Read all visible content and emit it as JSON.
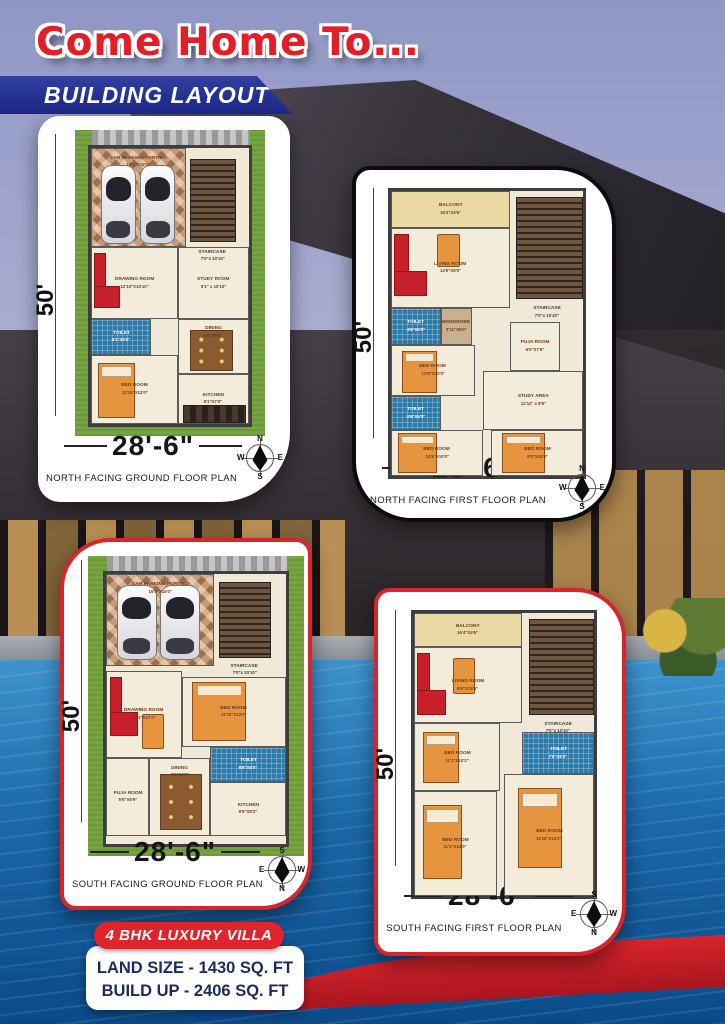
{
  "header": {
    "title": "Come Home To...",
    "banner": "BUILDING LAYOUT"
  },
  "footer": {
    "badge": "4 BHK LUXURY VILLA",
    "land_size": "LAND SIZE - 1430 SQ. FT",
    "build_up": "BUILD UP - 2406 SQ. FT"
  },
  "plans": [
    {
      "id": "north-ground",
      "title": "NORTH FACING GROUND FLOOR PLAN",
      "width_label": "28'-6\"",
      "height_label": "50'",
      "lawn": true,
      "compass": {
        "up": "N",
        "right": "E",
        "down": "S",
        "left": "W"
      },
      "rooms": [
        {
          "label": "CAR PARKING PORTICO",
          "dims": "16'4\"X15'0\"",
          "type": "carpark",
          "labelPos": "top",
          "x": 0,
          "y": 0,
          "w": 60,
          "h": 36
        },
        {
          "label": "",
          "dims": "",
          "type": "stairs",
          "x": 63,
          "y": 4,
          "w": 29,
          "h": 30
        },
        {
          "label": "Staircase",
          "dims": "7'0\"x 10'10\"",
          "type": "plain",
          "x": 58,
          "y": 34,
          "w": 38,
          "h": 10
        },
        {
          "label": "DRAWING ROOM",
          "dims": "12'10\"X10'10\"",
          "type": "room",
          "x": 0,
          "y": 36,
          "w": 55,
          "h": 26
        },
        {
          "label": "STUDY ROOM",
          "dims": "9'1\" x 10'10\"",
          "type": "room",
          "x": 55,
          "y": 36,
          "w": 45,
          "h": 26
        },
        {
          "label": "TOILET",
          "dims": "9'1\"X5'0\"",
          "type": "toilet",
          "x": 0,
          "y": 62,
          "w": 38,
          "h": 13
        },
        {
          "label": "DINING",
          "dims": "9'6\"X8'9\"",
          "type": "room",
          "labelPos": "top",
          "x": 55,
          "y": 62,
          "w": 45,
          "h": 20
        },
        {
          "label": "BED ROOM",
          "dims": "12'10\"X12'0\"",
          "type": "room",
          "x": 0,
          "y": 75,
          "w": 55,
          "h": 25
        },
        {
          "label": "KITCHEN",
          "dims": "9'1\"X7'0\"",
          "type": "room",
          "x": 55,
          "y": 82,
          "w": 45,
          "h": 18
        }
      ],
      "features": [
        {
          "type": "car",
          "x": 6,
          "y": 6,
          "w": 21,
          "h": 28
        },
        {
          "type": "car",
          "x": 31,
          "y": 6,
          "w": 21,
          "h": 28
        },
        {
          "type": "sofa",
          "x": 2,
          "y": 38,
          "w": 16,
          "h": 20
        },
        {
          "type": "bed",
          "x": 4,
          "y": 78,
          "w": 24,
          "h": 20
        },
        {
          "type": "table",
          "x": 63,
          "y": 66,
          "w": 26,
          "h": 14
        },
        {
          "type": "counter",
          "x": 58,
          "y": 93,
          "w": 39,
          "h": 6
        }
      ]
    },
    {
      "id": "north-first",
      "title": "NORTH FACING FIRST FLOOR PLAN",
      "width_label": "28'-6\"",
      "height_label": "50'",
      "lawn": false,
      "compass": {
        "up": "N",
        "right": "E",
        "down": "S",
        "left": "W"
      },
      "rooms": [
        {
          "label": "BALCONY",
          "dims": "16'4\"X4'6\"",
          "type": "balcony",
          "x": 0,
          "y": 0,
          "w": 62,
          "h": 13
        },
        {
          "label": "LIVING ROOM",
          "dims": "13'6\"X9'0\"",
          "type": "room",
          "x": 0,
          "y": 13,
          "w": 62,
          "h": 28
        },
        {
          "label": "",
          "dims": "",
          "type": "stairs",
          "x": 65,
          "y": 2,
          "w": 35,
          "h": 36
        },
        {
          "label": "Staircase",
          "dims": "7'0\"x 10'10\"",
          "type": "plain",
          "x": 62,
          "y": 38,
          "w": 38,
          "h": 9
        },
        {
          "label": "TOILET",
          "dims": "4'6\"X5'0\"",
          "type": "toilet",
          "x": 0,
          "y": 41,
          "w": 26,
          "h": 13
        },
        {
          "label": "WARDROBE",
          "dims": "3'11\"X5'0\"",
          "type": "wardrobe",
          "x": 26,
          "y": 41,
          "w": 16,
          "h": 13
        },
        {
          "label": "PUJA ROOM",
          "dims": "6'0\"X7'6\"",
          "type": "room",
          "x": 62,
          "y": 46,
          "w": 26,
          "h": 17
        },
        {
          "label": "BED ROOM",
          "dims": "12'6\"X10'0\"",
          "type": "room",
          "x": 0,
          "y": 54,
          "w": 44,
          "h": 18
        },
        {
          "label": "TOILET",
          "dims": "9'6\"X5'0\"",
          "type": "toilet",
          "x": 0,
          "y": 72,
          "w": 26,
          "h": 12
        },
        {
          "label": "STUDY AREA",
          "dims": "12'11\" x 8'9\"",
          "type": "room",
          "x": 48,
          "y": 63,
          "w": 52,
          "h": 21
        },
        {
          "label": "BED ROOM",
          "dims": "12'5\"X10'0\"",
          "type": "room",
          "x": 0,
          "y": 84,
          "w": 48,
          "h": 16
        },
        {
          "label": "BED ROOM",
          "dims": "9'6\"X12'0\"",
          "type": "room",
          "x": 52,
          "y": 84,
          "w": 48,
          "h": 16
        }
      ],
      "features": [
        {
          "type": "sofa",
          "x": 2,
          "y": 15,
          "w": 17,
          "h": 22
        },
        {
          "type": "chair",
          "x": 24,
          "y": 15,
          "w": 11,
          "h": 11
        },
        {
          "type": "bed",
          "x": 6,
          "y": 56,
          "w": 18,
          "h": 15
        },
        {
          "type": "bed",
          "x": 4,
          "y": 85,
          "w": 20,
          "h": 14
        },
        {
          "type": "bed",
          "x": 58,
          "y": 85,
          "w": 22,
          "h": 14
        }
      ]
    },
    {
      "id": "south-ground",
      "title": "SOUTH FACING GROUND FLOOR PLAN",
      "width_label": "28'-6\"",
      "height_label": "50'",
      "lawn": true,
      "compass": {
        "up": "S",
        "right": "W",
        "down": "N",
        "left": "E"
      },
      "rooms": [
        {
          "label": "CAR PARKING PORTICO",
          "dims": "16'4\"X15'0\"",
          "type": "carpark",
          "labelPos": "top",
          "x": 0,
          "y": 0,
          "w": 60,
          "h": 34
        },
        {
          "label": "",
          "dims": "",
          "type": "stairs",
          "x": 63,
          "y": 3,
          "w": 29,
          "h": 28
        },
        {
          "label": "Staircase",
          "dims": "7'0\"x 10'10\"",
          "type": "plain",
          "x": 58,
          "y": 31,
          "w": 38,
          "h": 9
        },
        {
          "label": "DRAWING ROOM",
          "dims": "11'1\"X17'2\"",
          "type": "room",
          "x": 0,
          "y": 36,
          "w": 42,
          "h": 32
        },
        {
          "label": "BED ROOM",
          "dims": "11'10\"X12'0\"",
          "type": "room",
          "x": 42,
          "y": 38,
          "w": 58,
          "h": 26
        },
        {
          "label": "TOILET",
          "dims": "8'9\"X5'0\"",
          "type": "toilet",
          "x": 58,
          "y": 64,
          "w": 42,
          "h": 13
        },
        {
          "label": "PUJA ROOM",
          "dims": "5'9\"X6'9\"",
          "type": "room",
          "x": 0,
          "y": 68,
          "w": 24,
          "h": 29
        },
        {
          "label": "DINING",
          "dims": "9'6\"X8'9\"",
          "type": "room",
          "labelPos": "top",
          "x": 24,
          "y": 68,
          "w": 34,
          "h": 29
        },
        {
          "label": "KITCHEN",
          "dims": "9'9\"X8'2\"",
          "type": "room",
          "x": 58,
          "y": 77,
          "w": 42,
          "h": 20
        }
      ],
      "features": [
        {
          "type": "car",
          "x": 6,
          "y": 4,
          "w": 21,
          "h": 27
        },
        {
          "type": "car",
          "x": 30,
          "y": 4,
          "w": 21,
          "h": 27
        },
        {
          "type": "sofa",
          "x": 2,
          "y": 38,
          "w": 16,
          "h": 22
        },
        {
          "type": "chair",
          "x": 20,
          "y": 52,
          "w": 11,
          "h": 12
        },
        {
          "type": "bed",
          "x": 48,
          "y": 40,
          "w": 30,
          "h": 22
        },
        {
          "type": "table",
          "x": 30,
          "y": 74,
          "w": 22,
          "h": 20
        }
      ]
    },
    {
      "id": "south-first",
      "title": "SOUTH FACING FIRST FLOOR PLAN",
      "width_label": "28'-6\"",
      "height_label": "50'",
      "lawn": false,
      "compass": {
        "up": "S",
        "right": "W",
        "down": "N",
        "left": "E"
      },
      "rooms": [
        {
          "label": "BALCONY",
          "dims": "16'4\"X4'6\"",
          "type": "balcony",
          "x": 0,
          "y": 0,
          "w": 60,
          "h": 12
        },
        {
          "label": "LIVING ROOM",
          "dims": "9'6\"X13'6\"",
          "type": "room",
          "x": 0,
          "y": 12,
          "w": 60,
          "h": 27
        },
        {
          "label": "",
          "dims": "",
          "type": "stairs",
          "x": 64,
          "y": 2,
          "w": 36,
          "h": 34
        },
        {
          "label": "Staircase",
          "dims": "7'0\"x 10'10\"",
          "type": "plain",
          "x": 60,
          "y": 36,
          "w": 40,
          "h": 9
        },
        {
          "label": "BED ROOM",
          "dims": "11'1\"X12'2\"",
          "type": "room",
          "x": 0,
          "y": 39,
          "w": 48,
          "h": 24
        },
        {
          "label": "TOILET",
          "dims": "7'6\"X5'0\"",
          "type": "toilet",
          "x": 60,
          "y": 42,
          "w": 40,
          "h": 15
        },
        {
          "label": "BED ROOM",
          "dims": "11'1\"X14'0\"",
          "type": "room",
          "x": 0,
          "y": 63,
          "w": 46,
          "h": 37
        },
        {
          "label": "BED ROOM",
          "dims": "11'10\"X12'2\"",
          "type": "room",
          "x": 50,
          "y": 57,
          "w": 50,
          "h": 43
        }
      ],
      "features": [
        {
          "type": "sofa",
          "x": 2,
          "y": 14,
          "w": 16,
          "h": 22
        },
        {
          "type": "chair",
          "x": 22,
          "y": 16,
          "w": 11,
          "h": 12
        },
        {
          "type": "bed",
          "x": 5,
          "y": 42,
          "w": 20,
          "h": 18
        },
        {
          "type": "bed",
          "x": 5,
          "y": 68,
          "w": 22,
          "h": 26
        },
        {
          "type": "bed",
          "x": 58,
          "y": 62,
          "w": 24,
          "h": 28
        }
      ]
    }
  ]
}
